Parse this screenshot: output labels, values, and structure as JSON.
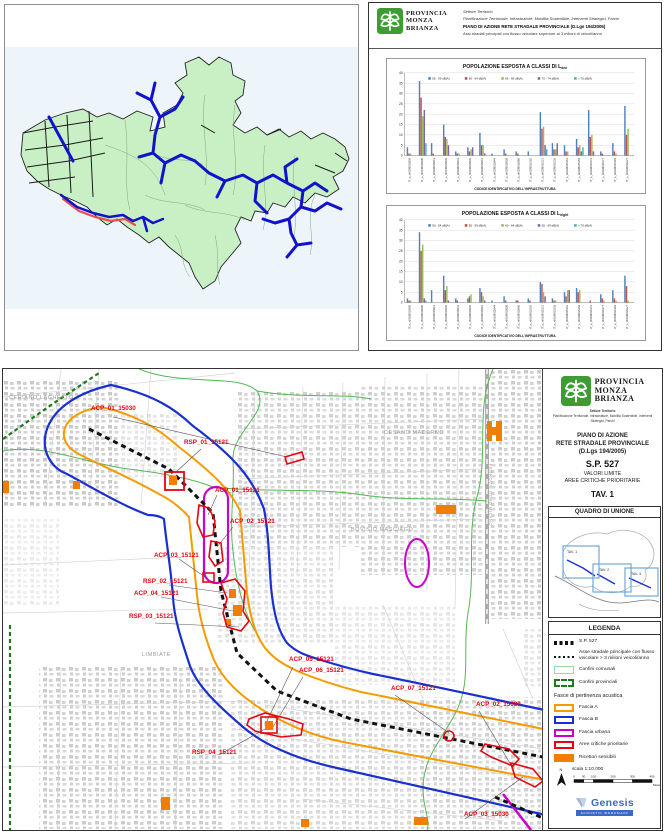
{
  "logo": {
    "line1": "PROVINCIA",
    "line2": "MONZA",
    "line3": "BRIANZA"
  },
  "report_panel": {
    "sector": "Settore Territorio",
    "department": "Pianificazione Territoriale, Infrastrutture, Mobilità Sostenibile, Interventi Strategici, Parchi",
    "title": "PIANO DI AZIONE RETE STRADALE PROVINCIALE (D.Lgs 194/2005)",
    "subtitle": "Assi stradali principali con flusso veicolare superiore ai 3 milioni di veicoli/anno"
  },
  "chart_data": [
    {
      "type": "bar",
      "title_main": "POPOLAZIONE ESPOSTA A CLASSI DI L",
      "title_sub": "den",
      "xlabel": "CODICE IDENTIFICATIVO DELL'INFRASTRUTTURA",
      "ylim": [
        0,
        40
      ],
      "ytick_step": 5,
      "grid": true,
      "legend_position": "top",
      "colors": [
        "#4F81BD",
        "#C0504D",
        "#9BBB59",
        "#8064A2",
        "#4BACC6"
      ],
      "categories": [
        "IT_a_rd0108015005",
        "IT_a_rd0108015006",
        "IT_a_rd0108015013",
        "IT_a_rd0108015030",
        "IT_a_rd0108015031",
        "IT_a_rd0108015035",
        "IT_a_rd0108015041",
        "IT_a_rd0108015044",
        "IT_a_rd0108015058",
        "IT_a_rd0108015060",
        "IT_a_rd0108015102",
        "IT_a_rd0108015121",
        "IT_a_rd0108015135",
        "IT_a_rd0108015151",
        "IT_a_rd0108015154",
        "IT_a_rd0108015173",
        "IT_a_rd0108015177",
        "IT_a_rd0108015193",
        "IT_a_rd0108015227"
      ],
      "series": [
        {
          "name": "55 - 59 dB(A)",
          "values": [
            4,
            36,
            6,
            15,
            2,
            4,
            11,
            1,
            3,
            2,
            2,
            21,
            6,
            5,
            8,
            22,
            2,
            6,
            24
          ]
        },
        {
          "name": "60 - 64 dB(A)",
          "values": [
            1,
            28,
            1,
            9,
            1,
            2,
            5,
            0,
            1,
            1,
            0,
            13,
            3,
            2,
            4,
            9,
            1,
            2,
            10
          ]
        },
        {
          "name": "65 - 69 dB(A)",
          "values": [
            1,
            19,
            0,
            8,
            1,
            3,
            5,
            0,
            0,
            0,
            0,
            14,
            3,
            2,
            5,
            10,
            0,
            1,
            13
          ]
        },
        {
          "name": "70 - 74 dB(A)",
          "values": [
            0,
            22,
            0,
            5,
            0,
            4,
            1,
            0,
            0,
            0,
            0,
            5,
            6,
            0,
            2,
            2,
            0,
            0,
            0
          ]
        },
        {
          "name": "> 75 dB(A)",
          "values": [
            0,
            6,
            0,
            0,
            0,
            0,
            0,
            0,
            0,
            0,
            0,
            3,
            0,
            0,
            4,
            0,
            0,
            0,
            0
          ]
        }
      ]
    },
    {
      "type": "bar",
      "title_main": "POPOLAZIONE ESPOSTA A CLASSI DI L",
      "title_sub": "night",
      "xlabel": "CODICE IDENTIFICATIVO DELL'INFRASTRUTTURA",
      "ylim": [
        0,
        40
      ],
      "ytick_step": 5,
      "grid": true,
      "legend_position": "top",
      "colors": [
        "#4F81BD",
        "#C0504D",
        "#9BBB59",
        "#8064A2",
        "#4BACC6"
      ],
      "categories": [
        "IT_a_rd0108015005",
        "IT_a_rd0108015006",
        "IT_a_rd0108015013",
        "IT_a_rd0108015030",
        "IT_a_rd0108015031",
        "IT_a_rd0108015035",
        "IT_a_rd0108015041",
        "IT_a_rd0108015044",
        "IT_a_rd0108015058",
        "IT_a_rd0108015060",
        "IT_a_rd0108015102",
        "IT_a_rd0108015121",
        "IT_a_rd0108015135",
        "IT_a_rd0108015151",
        "IT_a_rd0108015154",
        "IT_a_rd0108015173",
        "IT_a_rd0108015177",
        "IT_a_rd0108015193",
        "IT_a_rd0108015227"
      ],
      "series": [
        {
          "name": "50 - 54 dB(A)",
          "values": [
            2,
            34,
            6,
            13,
            2,
            2,
            7,
            1,
            3,
            1,
            2,
            10,
            2,
            5,
            7,
            0,
            4,
            6,
            13
          ]
        },
        {
          "name": "55 - 59 dB(A)",
          "values": [
            1,
            25,
            0,
            6,
            1,
            3,
            5,
            0,
            1,
            1,
            1,
            9,
            1,
            3,
            5,
            1,
            2,
            2,
            8
          ]
        },
        {
          "name": "60 - 64 dB(A)",
          "values": [
            1,
            28,
            0,
            8,
            0,
            4,
            3,
            0,
            0,
            0,
            0,
            5,
            1,
            6,
            6,
            0,
            1,
            1,
            1
          ]
        },
        {
          "name": "65 - 69 dB(A)",
          "values": [
            0,
            2,
            0,
            1,
            0,
            0,
            1,
            0,
            0,
            0,
            0,
            3,
            0,
            6,
            0,
            0,
            0,
            0,
            0
          ]
        },
        {
          "name": "> 70 dB(A)",
          "values": [
            0,
            1,
            0,
            0,
            0,
            0,
            0,
            0,
            0,
            0,
            0,
            0,
            0,
            0,
            0,
            0,
            0,
            0,
            0
          ]
        }
      ]
    }
  ],
  "bottom_map": {
    "labels": [
      "ACP_01_15030",
      "RSP_01_15121",
      "ACP_01_15121",
      "ACP_02_15121",
      "ACP_03_15121",
      "RSP_02_15121",
      "ACP_04_15121",
      "RSP_03_15121",
      "ACP_05_15121",
      "ACP_06_15121",
      "ACP_07_15121",
      "ACP_02_15030",
      "RSP_04_15121",
      "ACP_03_15030"
    ],
    "municipalities": [
      "CERIANO LAGHETTO",
      "CESANO MADERNO",
      "BOVISIO MASCIAGO",
      "LIMBIATE"
    ],
    "railway_label": "FERROVIE NORD MILANO",
    "title_block": {
      "sector": "Settore Territorio",
      "department": "Pianificazione Territoriale, Infrastrutture, Mobilità Sostenibile, Interventi Strategici, Parchi",
      "plan_line1": "PIANO DI AZIONE",
      "plan_line2": "RETE STRADALE PROVINCIALE",
      "plan_line3": "(D.Lgs 194/2005)",
      "road": "S.P. 527",
      "sub1": "VALORI LIMITE",
      "sub2": "AREE CRITICHE PRIORITARIE",
      "sheet": "TAV. 1"
    },
    "quadro": {
      "title": "QUADRO DI UNIONE",
      "tavs": [
        "TAV. 1",
        "TAV. 2",
        "TAV. 3"
      ]
    },
    "legend": {
      "title": "LEGENDA",
      "items": [
        {
          "key": "sp527",
          "label": "S.P. 527"
        },
        {
          "key": "asse",
          "label": "Asse stradale principale con flusso veicolare > 3 milioni veicoli/anno"
        },
        {
          "key": "comunali",
          "label": "Confini comunali"
        },
        {
          "key": "provinciali",
          "label": "Confini provinciali"
        }
      ],
      "fasce_header": "Fasce di pertinenza acustica",
      "fasce_items": [
        {
          "key": "fascia-a",
          "label": "Fascia A"
        },
        {
          "key": "fascia-b",
          "label": "Fascia B"
        },
        {
          "key": "fascia-urbana",
          "label": "Fascia urbana"
        },
        {
          "key": "aree",
          "label": "Aree critiche prioritarie"
        },
        {
          "key": "ricettori",
          "label": "Ricettori sensibili"
        }
      ]
    },
    "colors": {
      "fascia_a": "#f59b00",
      "fascia_b": "#1a2fd0",
      "fascia_urbana": "#cc00cc",
      "aree_critiche": "#e30613",
      "ricettori": "#f07f00",
      "sp527": "#111111",
      "confini_comunali": "#9fd89f",
      "confini_provinciali": "#1e7a1e"
    },
    "scale": {
      "label": "scala 1:10.000",
      "ticks": [
        "0",
        "50",
        "100",
        "200",
        "300",
        "400"
      ],
      "units": "Meters"
    },
    "north": "N",
    "credits": {
      "name": "Genesis",
      "tagline": "ACOUSTIC WORKSHOP"
    }
  }
}
